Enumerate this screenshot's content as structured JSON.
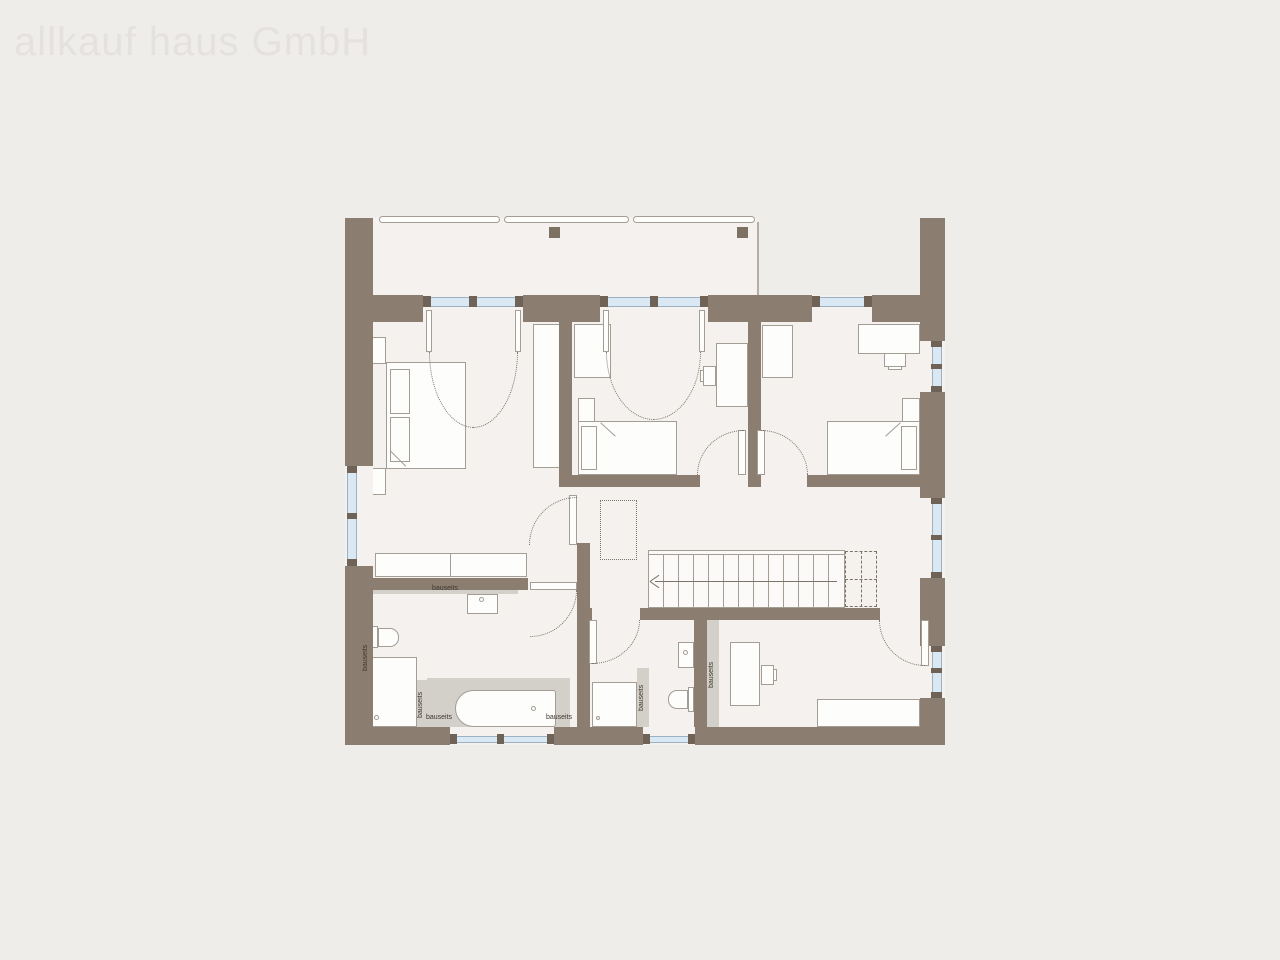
{
  "plan": {
    "watermark": "allkauf haus GmbH",
    "annotations": {
      "vanity": "bauseits",
      "wall_left": "bauseits",
      "shower_tub_divider": "bauseits",
      "tub_left": "bauseits",
      "tub_right": "bauseits",
      "wc_wall": "bauseits",
      "stair_wall": "bauseits"
    },
    "colors": {
      "background": "#efedea",
      "floor": "#f4f1ee",
      "wall": "#8b7e70",
      "window_glass": "#d9e8f2",
      "tile_strip": "#d3cfc9",
      "watermark": "#e4e1de"
    }
  }
}
